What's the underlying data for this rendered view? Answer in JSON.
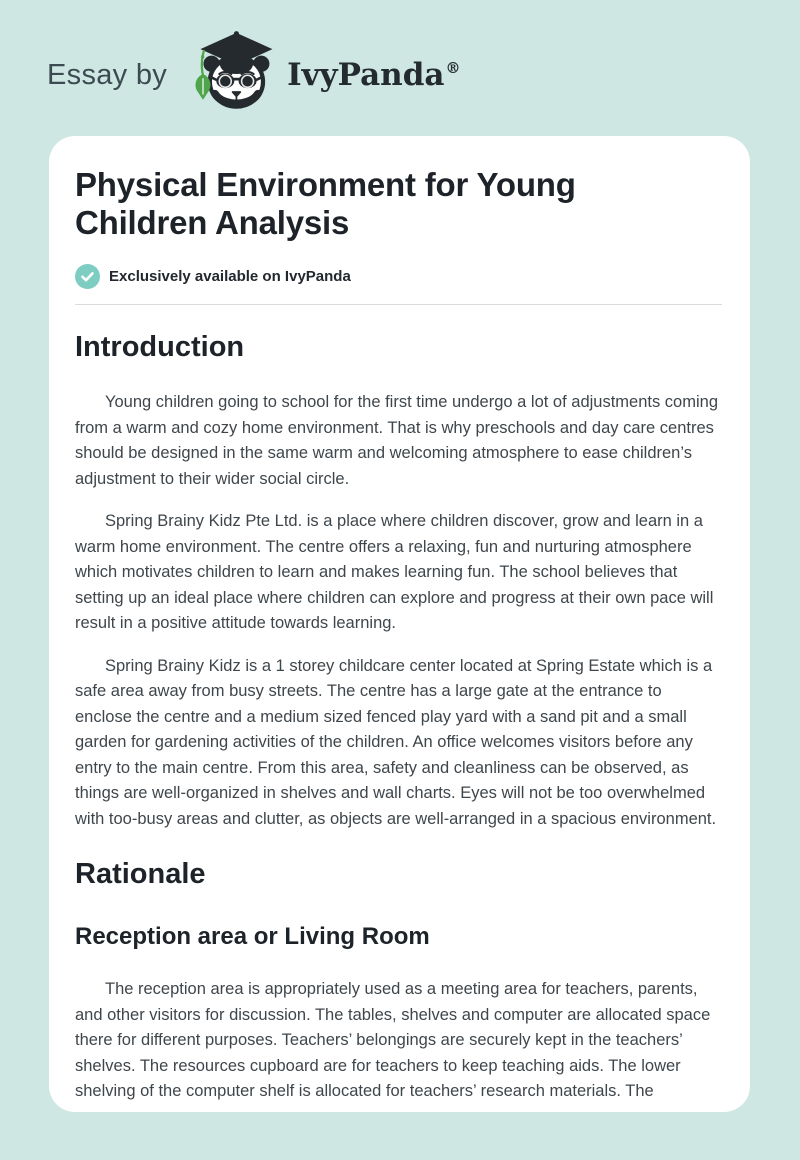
{
  "theme": {
    "page_background": "#cee7e2",
    "card_background": "#ffffff",
    "badge_teal": "#7ecdc3",
    "leaf_green": "#4fa54b",
    "heading_ink": "#1e2329",
    "body_ink": "#3f464b"
  },
  "header": {
    "essay_by": "Essay by",
    "brand": "IvyPanda",
    "registered_mark": "®",
    "logo_icon": "panda-graduate-icon"
  },
  "article": {
    "title": "Physical Environment for Young Children Analysis",
    "exclusive_badge": "Exclusively available on IvyPanda",
    "sections": [
      {
        "heading": "Introduction",
        "paragraphs": [
          "Young children going to school for the first time undergo a lot of adjustments coming from a warm and cozy home environment. That is why preschools and day care centres should be designed in the same warm and welcoming atmosphere to ease children’s adjustment to their wider social circle.",
          "Spring Brainy Kidz Pte Ltd. is a place where children discover, grow and learn in a warm home environment. The centre offers a relaxing, fun and nurturing atmosphere which motivates children to learn and makes learning fun. The school believes that setting up an ideal place where children can explore and progress at their own pace will result in a positive attitude towards learning.",
          "Spring Brainy Kidz is a 1 storey childcare center located at Spring Estate which is a safe area away from busy streets. The centre has a large gate at the entrance to enclose the centre and a medium sized fenced play yard with a sand pit and a small garden for gardening activities of the children. An office welcomes visitors before any entry to the main centre. From this area, safety and cleanliness can be observed, as things are well-organized in shelves and wall charts. Eyes will not be too overwhelmed with too-busy areas and clutter, as objects are well-arranged in a spacious environment."
        ]
      },
      {
        "heading": "Rationale",
        "subheading": "Reception area or Living Room",
        "paragraphs": [
          "The reception area is appropriately used as a meeting area for teachers, parents, and other visitors for discussion. The tables, shelves and computer are allocated space there for different purposes. Teachers’ belongings are securely kept in the teachers’ shelves. The resources cupboard are for teachers to keep teaching aids. The lower shelving of the computer shelf is allocated for teachers’ research materials. The"
        ]
      }
    ]
  }
}
